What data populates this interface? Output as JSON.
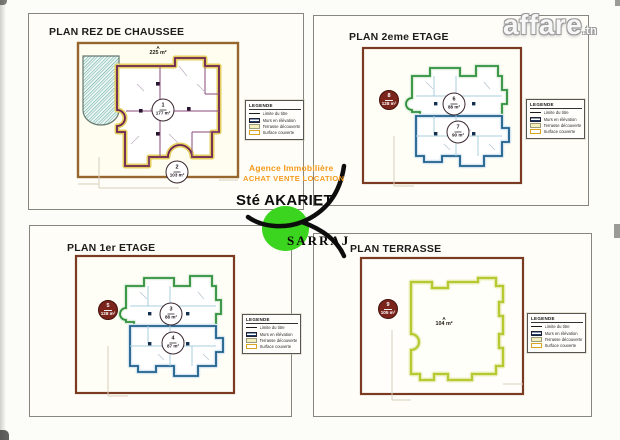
{
  "watermark": {
    "name": "affare",
    "tld": ".tn"
  },
  "logo": {
    "tagline1": "Agence Immobilière",
    "tagline2": "ACHAT VENTE LOCATION",
    "company": "Sté AKARIET",
    "company2": "SARRAJ"
  },
  "legend": {
    "title": "LEGENDE",
    "items": [
      {
        "label": "Limite du titre"
      },
      {
        "label": "Murs en élévation"
      },
      {
        "label": "Terrasse découverte"
      },
      {
        "label": "Surface couverte"
      }
    ]
  },
  "plans": [
    {
      "title": "PLAN REZ DE CHAUSSEE",
      "site_label": {
        "line1": "A",
        "line2": "225 m²"
      },
      "badges": [
        {
          "num": "1",
          "area": "177 m²"
        },
        {
          "num": "2",
          "area": "103 m²"
        }
      ]
    },
    {
      "title": "PLAN 2eme ETAGE",
      "badges": [
        {
          "num": "8",
          "area": "128 m²"
        },
        {
          "num": "6",
          "area": "88 m²"
        },
        {
          "num": "7",
          "area": "90 m²"
        }
      ]
    },
    {
      "title": "PLAN 1er ETAGE",
      "badges": [
        {
          "num": "5",
          "area": "128 m²"
        },
        {
          "num": "3",
          "area": "88 m²"
        },
        {
          "num": "4",
          "area": "87 m²"
        }
      ]
    },
    {
      "title": "PLAN TERRASSE",
      "center_label": {
        "line1": "A",
        "line2": "104 m²"
      },
      "badges": [
        {
          "num": "9",
          "area": "105 m²"
        }
      ]
    }
  ],
  "colors": {
    "accent_orange": "#f59a1e",
    "logo_green": "#3bd41e",
    "walls_rdc": "#6b2255",
    "outline_green": "#2f8f3a",
    "outline_blue": "#1f5f8a",
    "outline_terrace": "#b6c832",
    "site_border": "#7b3a22"
  }
}
